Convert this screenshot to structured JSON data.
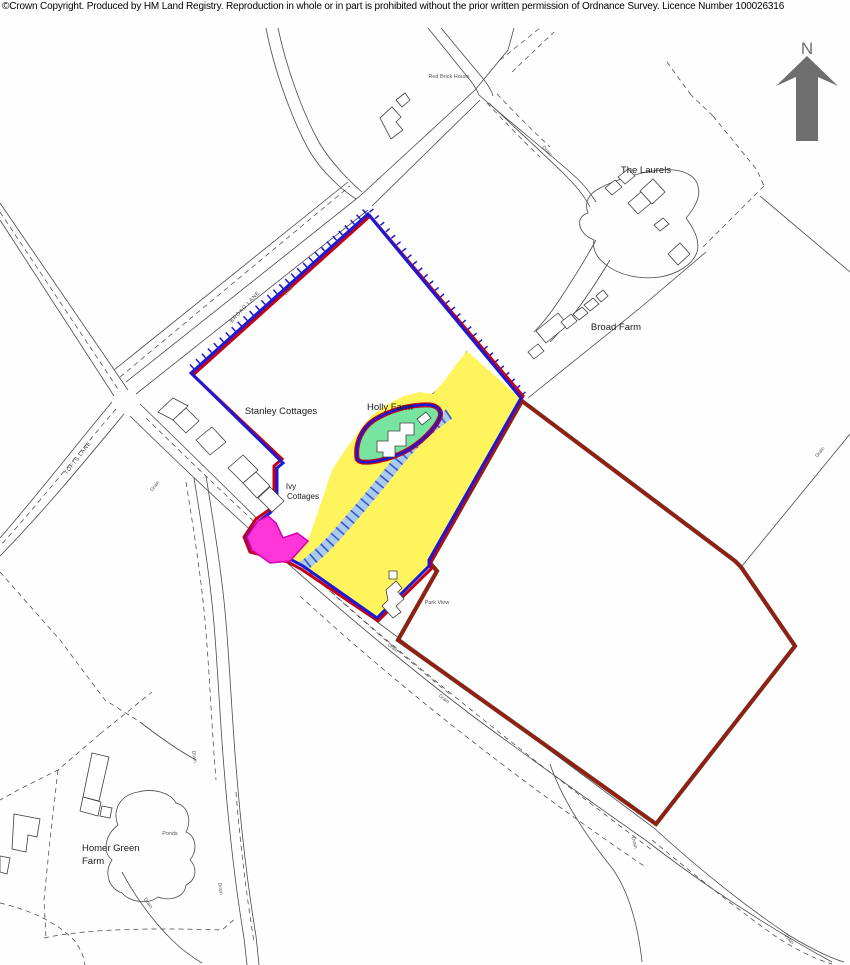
{
  "header": {
    "copyright_text": "©Crown Copyright.  Produced by HM Land Registry.  Reproduction in whole or in part is prohibited without the prior written permission of Ordnance Survey. Licence Number 100026316"
  },
  "compass": {
    "north_label": "N"
  },
  "map": {
    "colors": {
      "freehold_red": "#C40018",
      "title_blue": "#1A1AD6",
      "other_title_brown": "#63391D",
      "other_title_red": "#B50E0E",
      "yellow_tint": "#FFF45C",
      "green_tint": "#77E5A0",
      "pink_tint": "#FF35D8",
      "pink_edge": "#D800B0",
      "blue_strip": "#A9CCEE",
      "blue_strip_hatch": "#3A55C8",
      "road_line": "#4A4A4A",
      "north_arrow_gray": "#6E6E6E"
    },
    "place_labels": {
      "red_brick_house": "Red Brick House",
      "the_laurels": "The Laurels",
      "broad_farm": "Broad Farm",
      "stanley_cottages": "Stanley Cottages",
      "holly_farm": "Holly Farm",
      "ivy_cottages_line1": "Ivy",
      "ivy_cottages_line2": "Cottages",
      "park_view": "Park View",
      "homer_green_farm_line1": "Homer Green",
      "homer_green_farm_line2": "Farm",
      "ponds": "Ponds"
    },
    "road_labels": {
      "broad_lane": "BROAD LANE",
      "tofts_lane": "TOFTS LANE"
    },
    "water_labels": {
      "drain": "Drain"
    }
  }
}
